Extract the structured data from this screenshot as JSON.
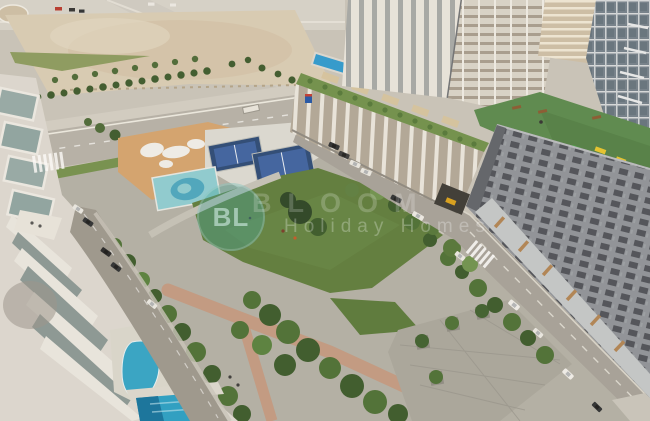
{
  "meta": {
    "type": "photograph",
    "description": "Aerial daytime view of a residential community: central park with lawn, padel courts, splash pad and playground, pools, white residential towers, a slatted parking podium with green roof edge, a grey mid-rise with rooftop turf playground, desert lots, and roads with parked cars."
  },
  "watermark": {
    "monogram": "BL",
    "brand": "BLOOM",
    "tagline": "Holiday Homes"
  },
  "palette": {
    "sand": "#d8cdb6",
    "asphalt": "#b6b2a9",
    "lawn_green": "#5e7d3e",
    "tree_green": "#3a5a2c",
    "court_navy": "#2c4a78",
    "court_blue": "#3e63a2",
    "splash_teal": "#8ecdd3",
    "pool_blue": "#2da4c9",
    "turf_roof": "#5a8a4e",
    "facade_grey": "#8e9298",
    "podium_cream": "#e6e2d9",
    "path_tan": "#c29a83",
    "watermark_teal": "#49a69c"
  }
}
